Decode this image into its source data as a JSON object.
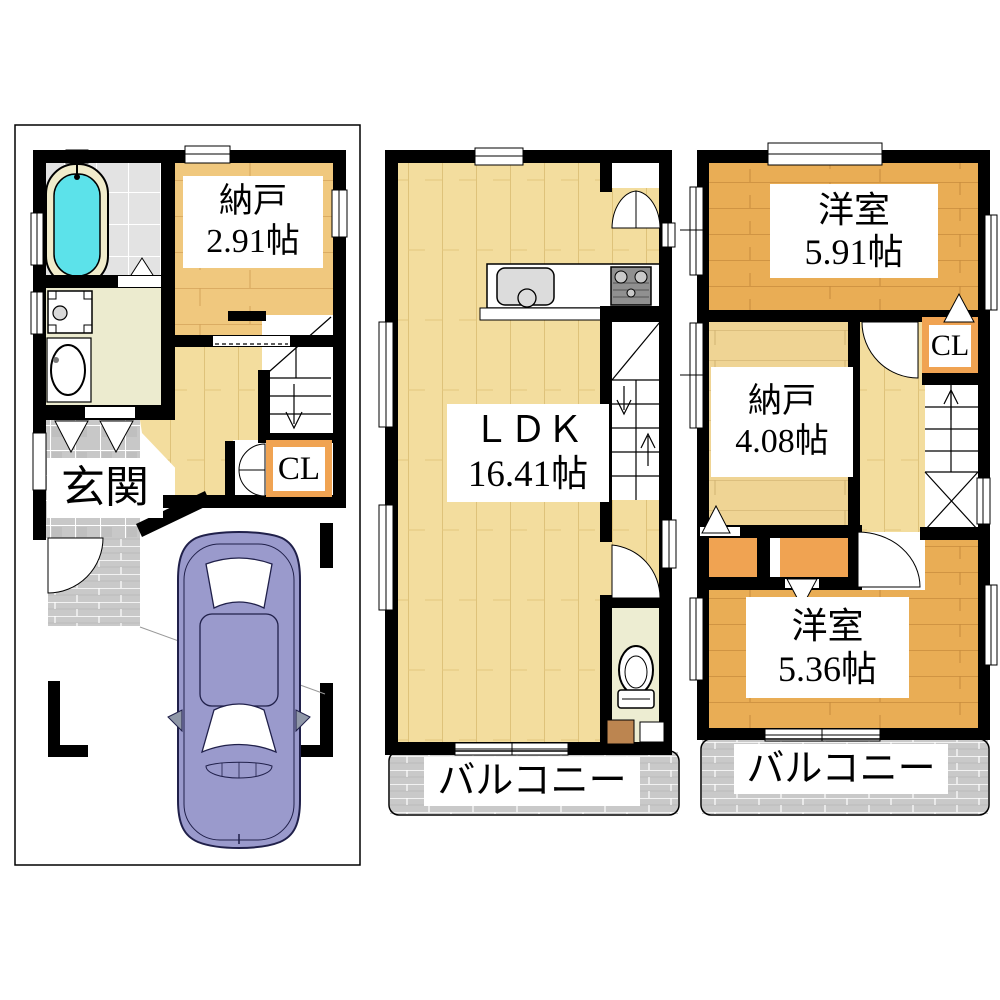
{
  "floor1": {
    "storage": {
      "name": "納戸",
      "area": "2.91帖"
    },
    "entrance": {
      "name": "玄関"
    },
    "closet": {
      "label": "CL"
    }
  },
  "floor2": {
    "ldk": {
      "name": "ＬＤＫ",
      "area": "16.41帖"
    },
    "balcony": {
      "name": "バルコニー"
    }
  },
  "floor3": {
    "western_room_upper": {
      "name": "洋室",
      "area": "5.91帖"
    },
    "closet": {
      "label": "CL"
    },
    "storage": {
      "name": "納戸",
      "area": "4.08帖"
    },
    "western_room_lower": {
      "name": "洋室",
      "area": "5.36帖"
    },
    "balcony": {
      "name": "バルコニー"
    }
  },
  "colors": {
    "wall": "#000000",
    "wood_light": "#F3DD9E",
    "wood_tan": "#F0C87E",
    "wood_dark": "#E9AD55",
    "wood_storage3": "#EFD494",
    "closet_orange": "#F0A352",
    "bathtub_cyan": "#5CE2EA",
    "balcony_gray": "#C9C9C9",
    "car_purple": "#9A9ACC",
    "washroom_cream": "#ECEBCF",
    "toilet_cream": "#EDEDD2"
  }
}
